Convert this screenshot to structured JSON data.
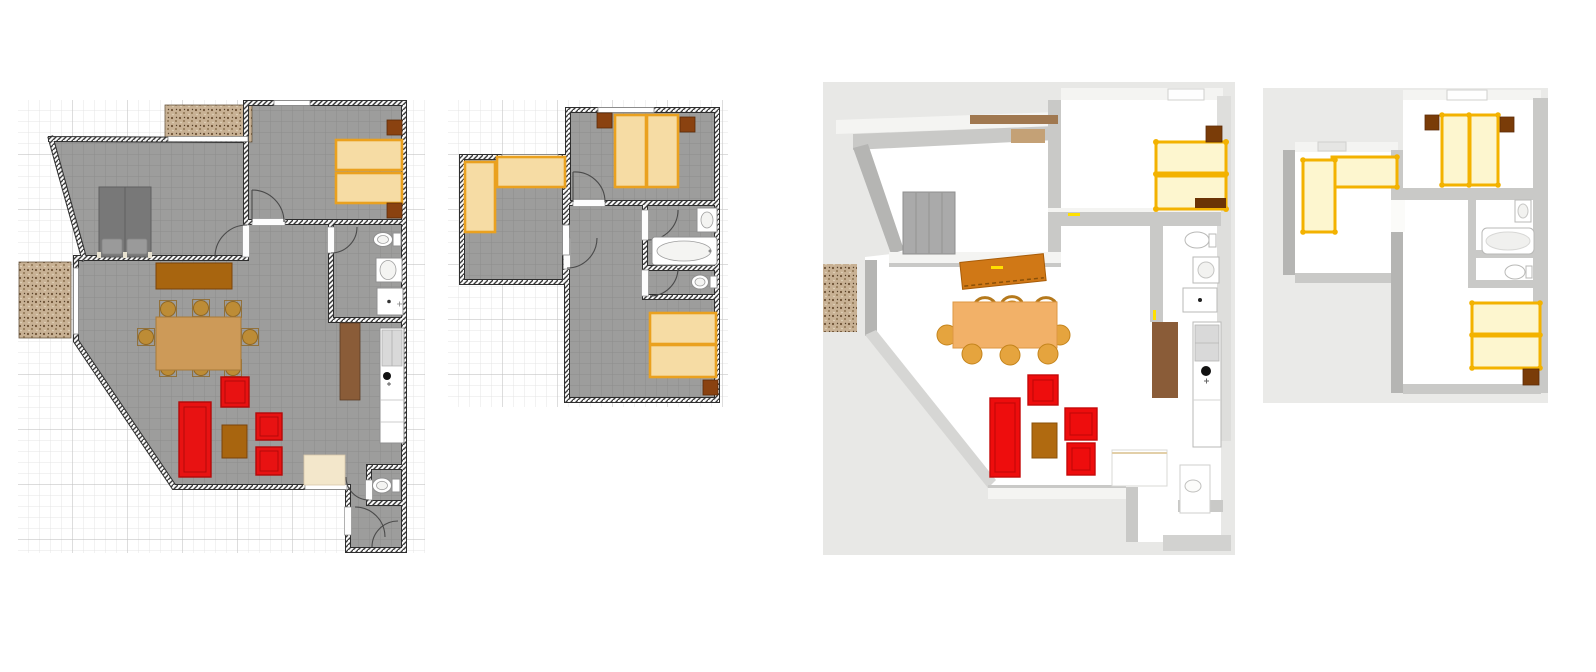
{
  "document": {
    "kind": "home-floor-plan-sheet",
    "panels": [
      {
        "id": "plan-2d-ground-floor",
        "view": "2d-plan",
        "floor": "ground",
        "rooms": [
          "bedroom-west",
          "bedroom-east",
          "bathroom",
          "living-dining-room",
          "kitchen",
          "wc",
          "entry-hall"
        ],
        "furniture": [
          "terrace-north",
          "terrace-west",
          "double-bed-gray",
          "twin-bed",
          "twin-bed",
          "nightstand",
          "nightstand",
          "sideboard",
          "dining-table",
          "dining-chair-x8",
          "red-armchair-x3",
          "red-sofa",
          "coffee-table",
          "door-mat",
          "tall-cabinet",
          "kitchen-counter",
          "fridge",
          "sink",
          "toilet",
          "washbasin",
          "shower",
          "wc-toilet"
        ]
      },
      {
        "id": "plan-2d-upper-floor",
        "view": "2d-plan",
        "floor": "upper",
        "rooms": [
          "bedroom-northeast",
          "bedroom-west",
          "bathroom",
          "wc",
          "bedroom-south",
          "landing-hall"
        ],
        "furniture": [
          "double-bed",
          "nightstand",
          "nightstand",
          "single-bed-vertical",
          "single-bed-horizontal",
          "washbasin",
          "bathtub",
          "wc-toilet",
          "double-bed-south",
          "nightstand"
        ]
      },
      {
        "id": "render-3d-ground-floor",
        "view": "3d-aerial-render",
        "floor": "ground",
        "furniture": [
          "wardrobe-gray",
          "twin-bed-gold",
          "twin-bed-gold",
          "nightstand",
          "sideboard-tilted",
          "dining-table",
          "dining-chair-x8",
          "red-sofa",
          "red-armchair-x3",
          "coffee-table",
          "terrace-west",
          "tall-cabinet",
          "kitchen-counter",
          "fridge",
          "toilet",
          "washbasin",
          "shower",
          "entry-bench",
          "wc-toilet",
          "skylight",
          "window-lintel"
        ]
      },
      {
        "id": "render-3d-upper-floor",
        "view": "3d-aerial-render",
        "floor": "upper",
        "furniture": [
          "double-bed-gold",
          "nightstand",
          "nightstand",
          "single-bed-gold-vertical",
          "single-bed-gold-horizontal",
          "washbasin",
          "bathtub",
          "wc-toilet",
          "double-bed-gold-south",
          "nightstand",
          "skylight",
          "skylight"
        ]
      }
    ]
  },
  "colors": {
    "plan-floor": "#9d9d9c",
    "plan-wall": "#2e2e2e",
    "grid-minor": "#e4e4e4",
    "grid-major": "#c6c6c6",
    "bed-fill": "#f6dca4",
    "bed-frame": "#eaa11f",
    "wood-dark": "#8a4210",
    "wood-mid": "#a8650f",
    "table": "#cd9a58",
    "chair": "#bd8c36",
    "red": "#e81212",
    "red-dark": "#b30909",
    "rug": "#f3e7cb",
    "terr-base": "#c8b194",
    "terr-dot": "#6f5336",
    "graybed": "#787878",
    "graybed-light": "#9a9a9a",
    "r-bg": "#e8e8e6",
    "r-wall": "#c9c9c7",
    "r-wall-dark": "#b5b5b3",
    "r-wall-light": "#f4f4f2",
    "gold": "#f3b200",
    "gold-fill": "#fdf6cf",
    "r-table": "#f2b168",
    "r-chair": "#e5a43e",
    "r-red": "#ee0d0d",
    "r-sideboard": "#d07816",
    "cabinet": "#8a5c38",
    "fixture": "#d9d9d9",
    "white": "#ffffff"
  }
}
